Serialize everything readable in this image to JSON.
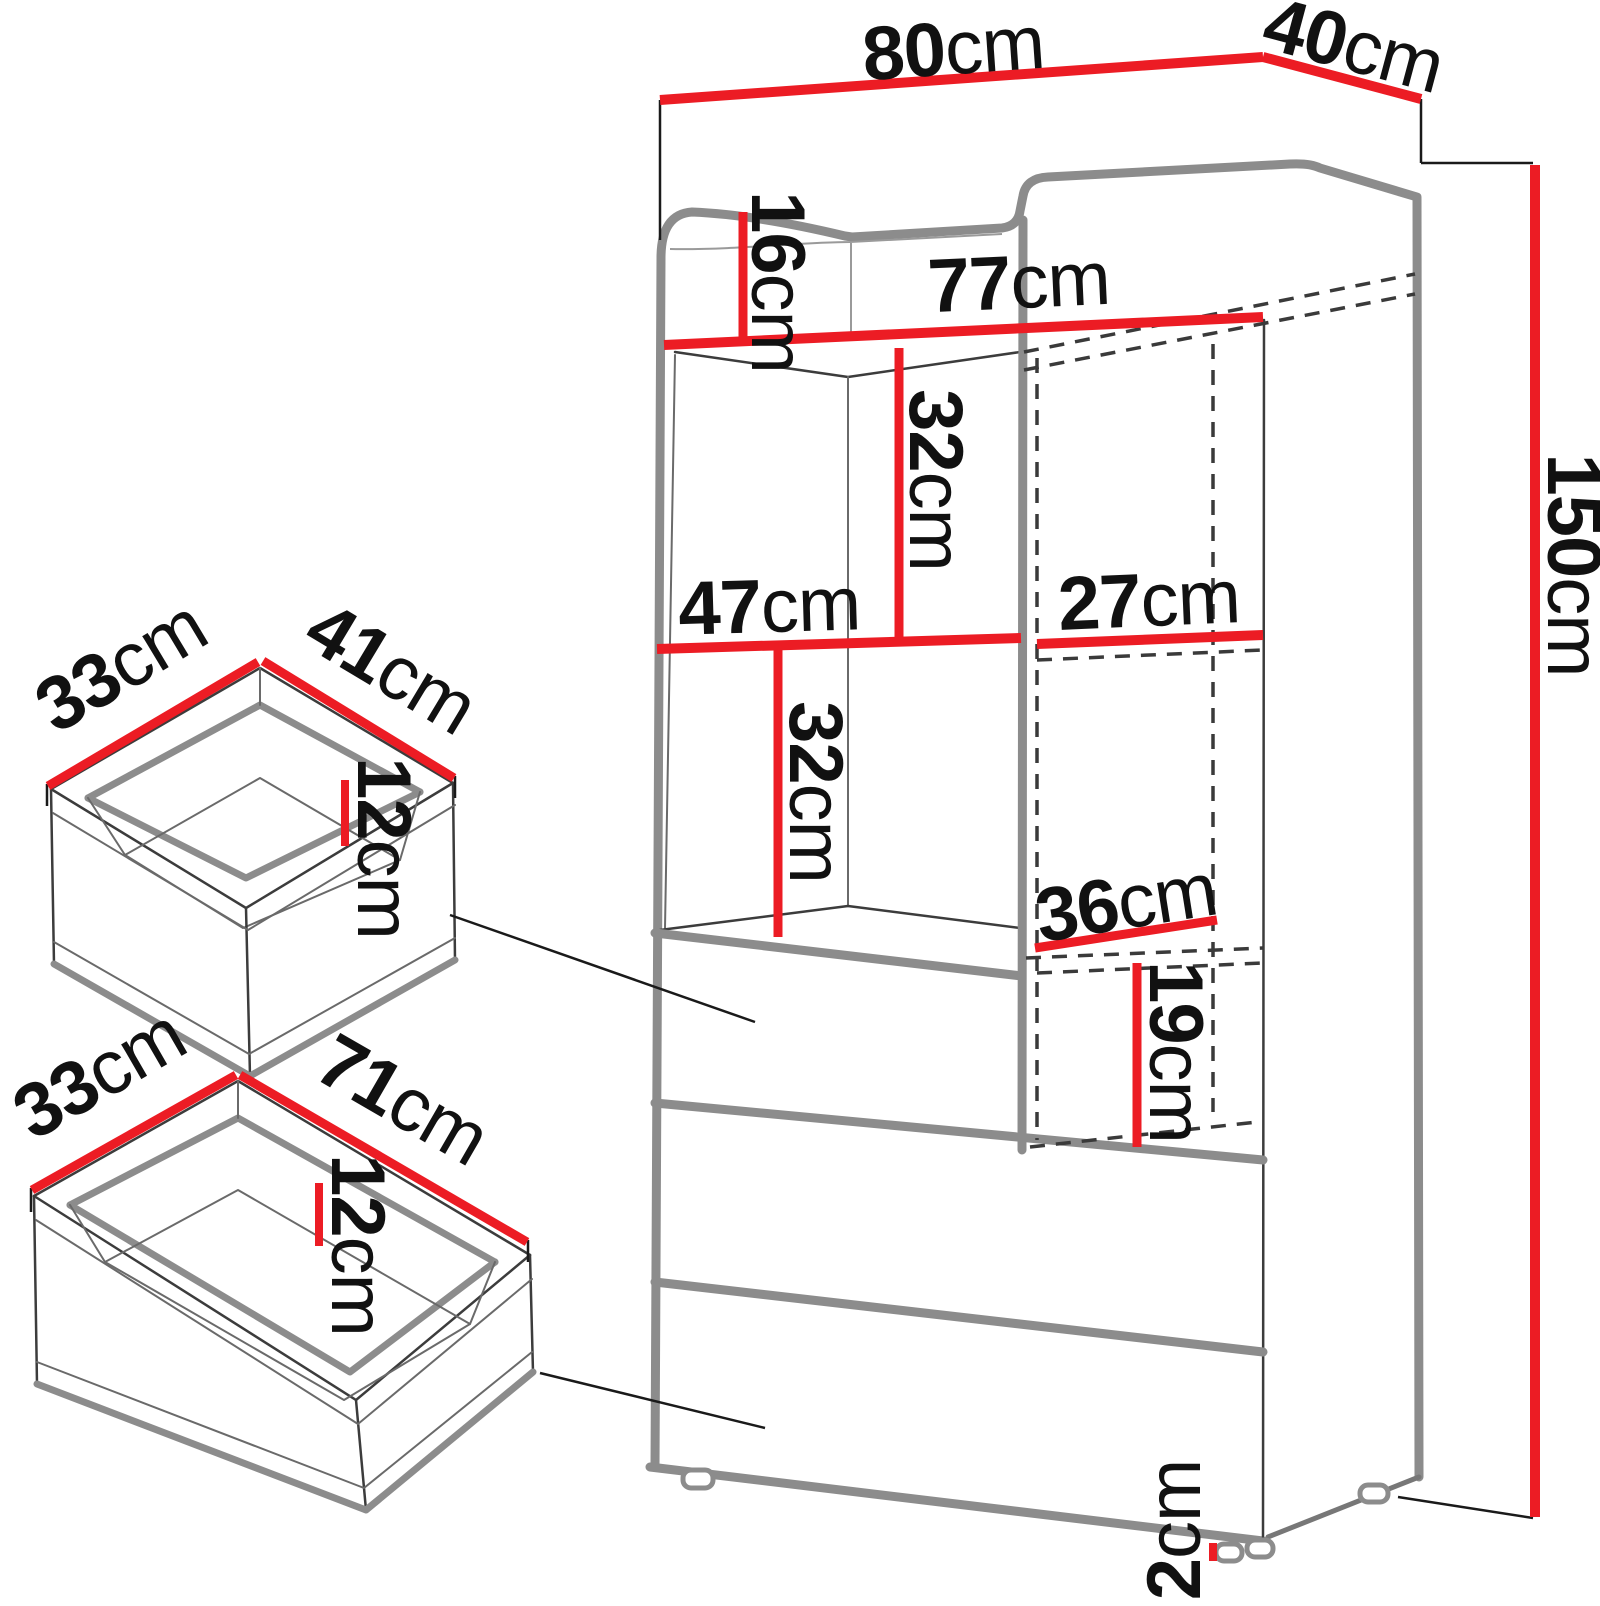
{
  "cabinet": {
    "width": {
      "value": "80",
      "unit": "cm"
    },
    "depth": {
      "value": "40",
      "unit": "cm"
    },
    "height": {
      "value": "150",
      "unit": "cm"
    },
    "top_rail_height": {
      "value": "16",
      "unit": "cm"
    },
    "interior_width": {
      "value": "77",
      "unit": "cm"
    },
    "left_section_width": {
      "value": "47",
      "unit": "cm"
    },
    "right_section_width": {
      "value": "27",
      "unit": "cm"
    },
    "upper_compartment_height": {
      "value": "32",
      "unit": "cm"
    },
    "lower_compartment_height": {
      "value": "32",
      "unit": "cm"
    },
    "right_niche_depth": {
      "value": "36",
      "unit": "cm"
    },
    "right_niche_height": {
      "value": "19",
      "unit": "cm"
    },
    "foot_height": {
      "value": "2",
      "unit": "cm"
    }
  },
  "small_drawer": {
    "depth": {
      "value": "33",
      "unit": "cm"
    },
    "width": {
      "value": "41",
      "unit": "cm"
    },
    "height": {
      "value": "12",
      "unit": "cm"
    }
  },
  "large_drawer": {
    "depth": {
      "value": "33",
      "unit": "cm"
    },
    "width": {
      "value": "71",
      "unit": "cm"
    },
    "height": {
      "value": "12",
      "unit": "cm"
    }
  },
  "colors": {
    "dimension_line": "#ec1c24",
    "outline_gray": "#8c8c8c",
    "hidden_line": "#3a3a3a",
    "text": "#111111",
    "background": "#ffffff"
  }
}
